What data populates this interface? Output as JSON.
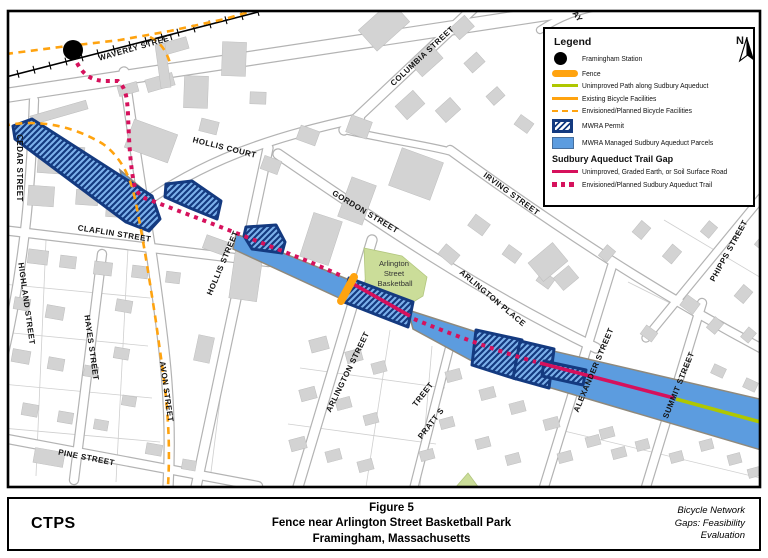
{
  "figure": {
    "org": "CTPS",
    "title_lines": [
      "Figure 5",
      "Fence near Arlington Street Basketball Park",
      "Framingham, Massachusetts"
    ],
    "right_lines": [
      "Bicycle Network",
      "Gaps: Feasibility",
      "Evaluation"
    ]
  },
  "legend": {
    "title": "Legend",
    "north": "N",
    "items": [
      {
        "id": "station",
        "label": "Framingham Station"
      },
      {
        "id": "fence",
        "label": "Fence"
      },
      {
        "id": "unimproved-path",
        "label": "Unimproved Path along Sudbury Aqueduct"
      },
      {
        "id": "existing-bike",
        "label": "Existing Bicycle Facilities"
      },
      {
        "id": "planned-bike",
        "label": "Envisioned/Planned Bicycle Facilities"
      },
      {
        "id": "mwra-permit",
        "label": "MWRA Permit"
      },
      {
        "id": "mwra-parcels",
        "label": "MWRA Managed Sudbury Aqueduct Parcels"
      }
    ],
    "subheading": "Sudbury Aqueduct Trail Gap",
    "sub_items": [
      {
        "id": "gap-unimproved",
        "label": "Unimproved, Graded Earth, or Soil Surface Road"
      },
      {
        "id": "gap-planned",
        "label": "Envisioned/Planned Sudbury Aqueduct Trail"
      }
    ]
  },
  "map": {
    "park_label_lines": [
      "Arlington",
      "Street",
      "Basketball"
    ],
    "street_labels": {
      "waverly": "WAVERLY STREET",
      "cedar": "CEDAR STREET",
      "taylor": "TAY",
      "hollis_court": "HOLLIS COURT",
      "columbia": "COLUMBIA STREET",
      "gordon": "GORDON STREET",
      "irving": "IRVING STREET",
      "claflin": "CLAFLIN STREET",
      "highland": "HIGHLAND STREET",
      "hayes": "HAYES STREET",
      "avon": "AVON STREET",
      "pine": "PINE STREET",
      "hollis": "HOLLIS STREET",
      "arlington_st": "ARLINGTON STREET",
      "arlington_pl": "ARLINGTON PLACE",
      "pratt_1": "PRATT S",
      "pratt_2": "TREET",
      "alexander": "ALEXANDER STREET",
      "summit": "SUMMIT STREET",
      "phipps": "PHIPPS STREET"
    }
  },
  "colors": {
    "aqueduct_blue": "#5C9CDF",
    "mwra_navy": "#143A80",
    "hatch_fill": "#7DB2EC",
    "trail_crimson": "#D6115C",
    "bike_orange": "#FFA30F",
    "path_green": "#AFC700",
    "park_green": "#CBDD99",
    "building_gray": "#D3D3D3"
  }
}
